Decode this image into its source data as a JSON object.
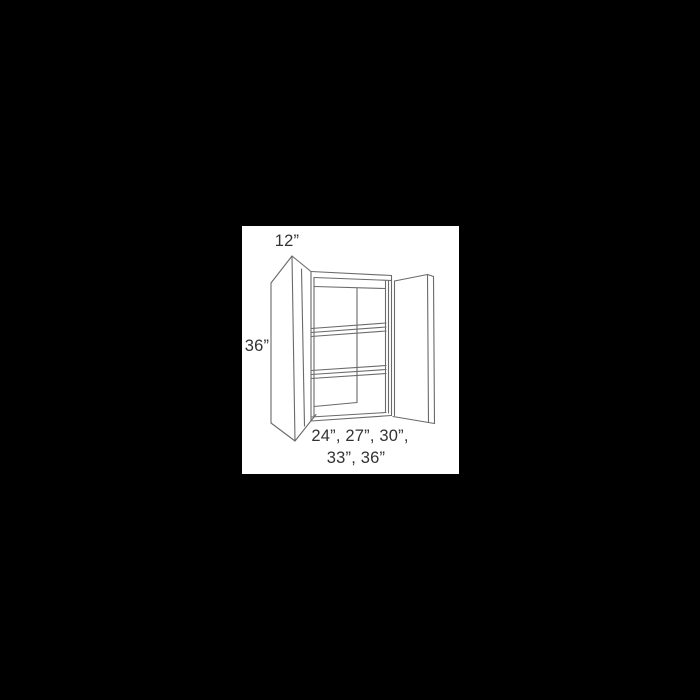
{
  "scene": {
    "background_color": "#000000",
    "panel_color": "#ffffff",
    "line_color": "#6a6a6a",
    "text_color": "#333333"
  },
  "diagram": {
    "type": "cabinet-line-drawing",
    "description": "wall cabinet with two open doors and two interior shelves",
    "labels": {
      "depth": "12”",
      "height": "36”",
      "widths_line1": "24”, 27”, 30”,",
      "widths_line2": "33”, 36”"
    },
    "drawing": {
      "viewbox": "242 226 217 248",
      "width": 217,
      "height": 248,
      "stroke_width": 1.1,
      "lines": [
        [
          271,
          283,
          292,
          256
        ],
        [
          271,
          283,
          271,
          423
        ],
        [
          271,
          423,
          295,
          441
        ],
        [
          292,
          256,
          295,
          441
        ],
        [
          292,
          256,
          311,
          271.5
        ],
        [
          301.5,
          269,
          304.5,
          426
        ],
        [
          295,
          441,
          316,
          414.5
        ],
        [
          311,
          271.5,
          311,
          421
        ],
        [
          314,
          277.5,
          314,
          417
        ],
        [
          311,
          271.5,
          391.5,
          275.5
        ],
        [
          314,
          277.5,
          391.5,
          280.5
        ],
        [
          314,
          286.5,
          385.5,
          288.5
        ],
        [
          357,
          288.5,
          357,
          402.5
        ],
        [
          314,
          406.5,
          357,
          402.5
        ],
        [
          311,
          328.5,
          386,
          323
        ],
        [
          311,
          332.5,
          386,
          327
        ],
        [
          311,
          336.5,
          386,
          331
        ],
        [
          311,
          370.5,
          386,
          365.5
        ],
        [
          311,
          374.5,
          386,
          369.5
        ],
        [
          311,
          378.5,
          386,
          373.5
        ],
        [
          311,
          417,
          386,
          412.5
        ],
        [
          311,
          421,
          391.5,
          415.5
        ],
        [
          385.5,
          281,
          385.5,
          412.5
        ],
        [
          388.5,
          281,
          388.5,
          413
        ],
        [
          391.5,
          275.5,
          391.5,
          415.5
        ],
        [
          394.5,
          281,
          394.5,
          415.5
        ],
        [
          394.5,
          281,
          427.5,
          274.5
        ],
        [
          427.5,
          274.5,
          433.5,
          276.5
        ],
        [
          427.5,
          274.5,
          428.5,
          422.5
        ],
        [
          433.5,
          276.5,
          434.5,
          423.5
        ],
        [
          393,
          416.5,
          428.5,
          422.5
        ],
        [
          428.5,
          422.5,
          434.5,
          423.5
        ]
      ]
    }
  }
}
